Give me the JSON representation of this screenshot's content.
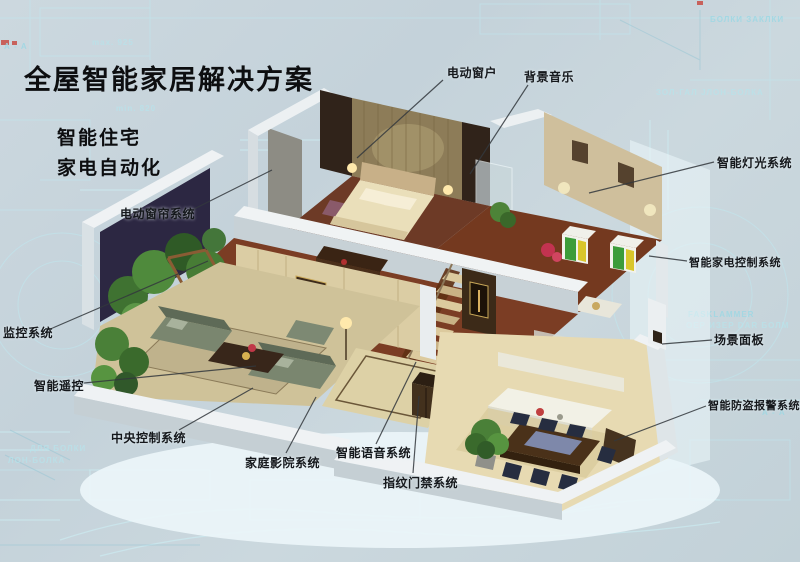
{
  "header": {
    "title": "全屋智能家居解决方案",
    "subtitle_lines": [
      "智能住宅",
      "家电自动化"
    ]
  },
  "callouts": {
    "items": [
      {
        "id": "electric-window",
        "text": "电动窗户"
      },
      {
        "id": "background-music",
        "text": "背景音乐"
      },
      {
        "id": "smart-lighting-system",
        "text": "智能灯光系统"
      },
      {
        "id": "smart-appliance-control-system",
        "text": "智能家电控制系统"
      },
      {
        "id": "scene-panel",
        "text": "场景面板"
      },
      {
        "id": "smart-burglar-alarm-system",
        "text": "智能防盗报警系统"
      },
      {
        "id": "electric-curtain-system",
        "text": "电动窗帘系统"
      },
      {
        "id": "monitoring-system",
        "text": "监控系统"
      },
      {
        "id": "smart-remote-control",
        "text": "智能遥控"
      },
      {
        "id": "central-control-system",
        "text": "中央控制系统"
      },
      {
        "id": "home-theater-system",
        "text": "家庭影院系统"
      },
      {
        "id": "smart-voice-system",
        "text": "智能语音系统"
      },
      {
        "id": "fingerprint-access-system",
        "text": "指纹门禁系统"
      }
    ]
  },
  "background_texts": {
    "items": [
      {
        "text": "А - А"
      },
      {
        "text": "max. 925"
      },
      {
        "text": "min. 820"
      },
      {
        "text": "БОЛКИ ЗАКЛКИ"
      },
      {
        "text": "ЗОЛ-ГАЛ  JЛОН-БОЛКА"
      },
      {
        "text": "FASKLAMMER"
      },
      {
        "text": "ОЕР ИЗЕР DAR БОЛМ"
      },
      {
        "text": "А - А"
      },
      {
        "text": "ДЛЯ БОЛКИ"
      },
      {
        "text": "ЛОН-БОЛКА"
      }
    ]
  },
  "colors": {
    "background": "#c7d4dc",
    "blueprint_line": "#aee4ee",
    "label_text": "#15181c",
    "callout_line": "#33383d",
    "wall_white": "#eff2f4",
    "floor_wood_dark": "#6d3a26",
    "floor_cream": "#e7dab2",
    "wall_beige": "#cfbf9c",
    "accent_green": "#3c9c3a",
    "accent_yellow": "#d9c62b",
    "plant_green": "#4a8038"
  }
}
